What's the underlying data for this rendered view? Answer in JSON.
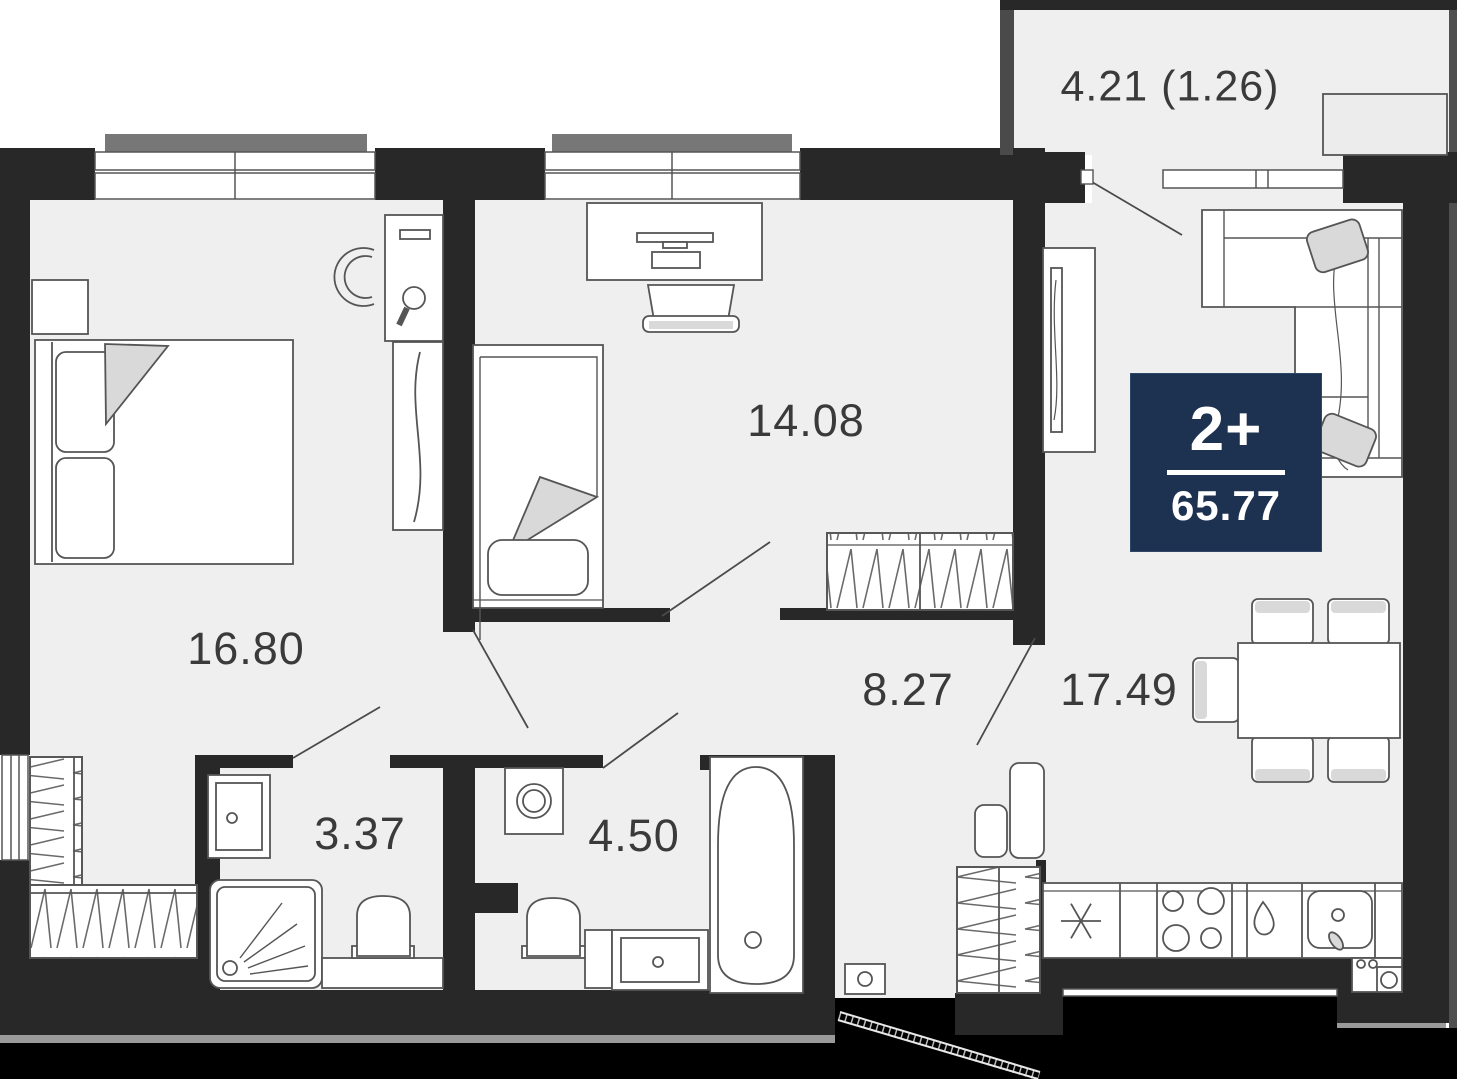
{
  "plan": {
    "badge": {
      "rooms": "2+",
      "area": "65.77"
    },
    "rooms": [
      {
        "name": "bedroom-1",
        "area": "16.80"
      },
      {
        "name": "bedroom-2",
        "area": "14.08"
      },
      {
        "name": "hallway",
        "area": "8.27"
      },
      {
        "name": "kitchen-living",
        "area": "17.49"
      },
      {
        "name": "bathroom-1",
        "area": "3.37"
      },
      {
        "name": "bathroom-2",
        "area": "4.50"
      },
      {
        "name": "balcony",
        "area": "4.21 (1.26)"
      }
    ],
    "colors": {
      "wall": "#282828",
      "floor": "#efefef",
      "badge_bg": "#1d3150",
      "furniture_line": "#555555",
      "accent_fill": "#d9d9d9",
      "label_text": "#3a3a3a"
    }
  }
}
